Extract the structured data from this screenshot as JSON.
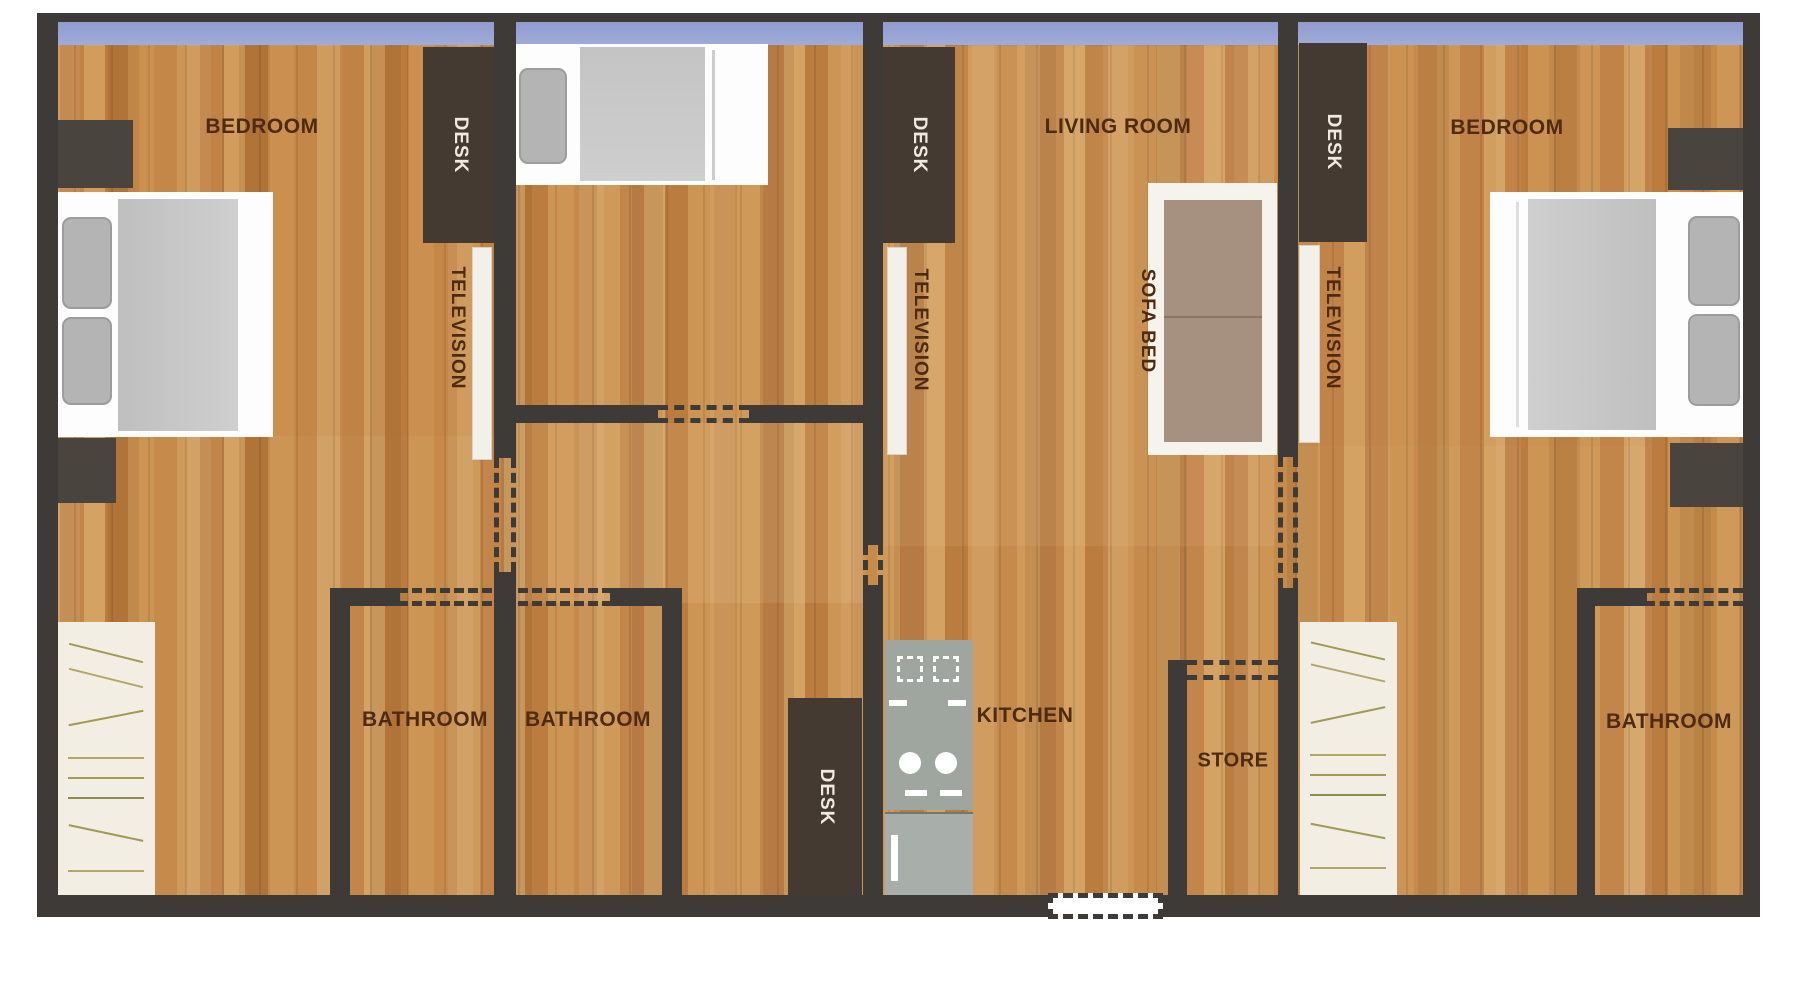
{
  "plan_title": "apartment floor plan",
  "labels": {
    "bedroom_left": "BEDROOM",
    "bedroom_right": "BEDROOM",
    "living_room": "LIVING ROOM",
    "kitchen": "KITCHEN",
    "bathroom_1": "BATHROOM",
    "bathroom_2": "BATHROOM",
    "bathroom_3": "BATHROOM",
    "store": "STORE",
    "sofa_bed": "SOFA BED",
    "desk_1": "DESK",
    "desk_2": "DESK",
    "desk_3": "DESK",
    "desk_4": "DESK",
    "television_1": "TELEVISION",
    "television_2": "TELEVISION",
    "television_3": "TELEVISION"
  },
  "colors": {
    "wall": "#3e3a38",
    "wood_base": "#c78e4d",
    "window_band": "#9aa6d4",
    "label_text": "#4e2b10",
    "desk_fill": "#453a31",
    "desk_text": "#efe9e1",
    "nightstand": "#49443e",
    "tv_panel": "#f3f0e9",
    "bed_frame": "#fdfdfd",
    "bedding": "#c7c7c7",
    "pillow": "#b4b4b4",
    "sofa_cushion": "#a69181",
    "closet_fill": "#f2eee4",
    "closet_hatch": "#a09a52",
    "stove": "#9fa6a0",
    "fridge": "#a8aea9"
  }
}
